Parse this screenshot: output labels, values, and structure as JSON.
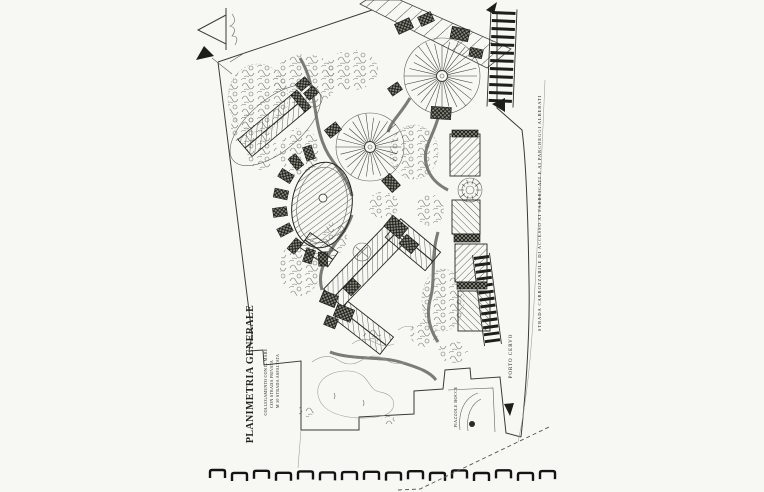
{
  "plan": {
    "title": "PLANIMETRIA GENERALE",
    "notes": [
      "COLLEGAMENTO CON IL MARE",
      "CON STRADA PRIVATA",
      "M 50 STRADA ASFALTATA"
    ],
    "road_annotation": "STRADA CARROZZABILE DI ACCESSO AI FABBRICATI E AI PARCHEGGI ALBERATI",
    "place_label": "PORTO CERVO",
    "ramp_label": "PIAZZOLE BOCCE",
    "symbols": {
      "north_arrow": "compass-north-arrow"
    },
    "colors": {
      "ink": "#26261f",
      "paper": "#f7f7f4"
    }
  }
}
